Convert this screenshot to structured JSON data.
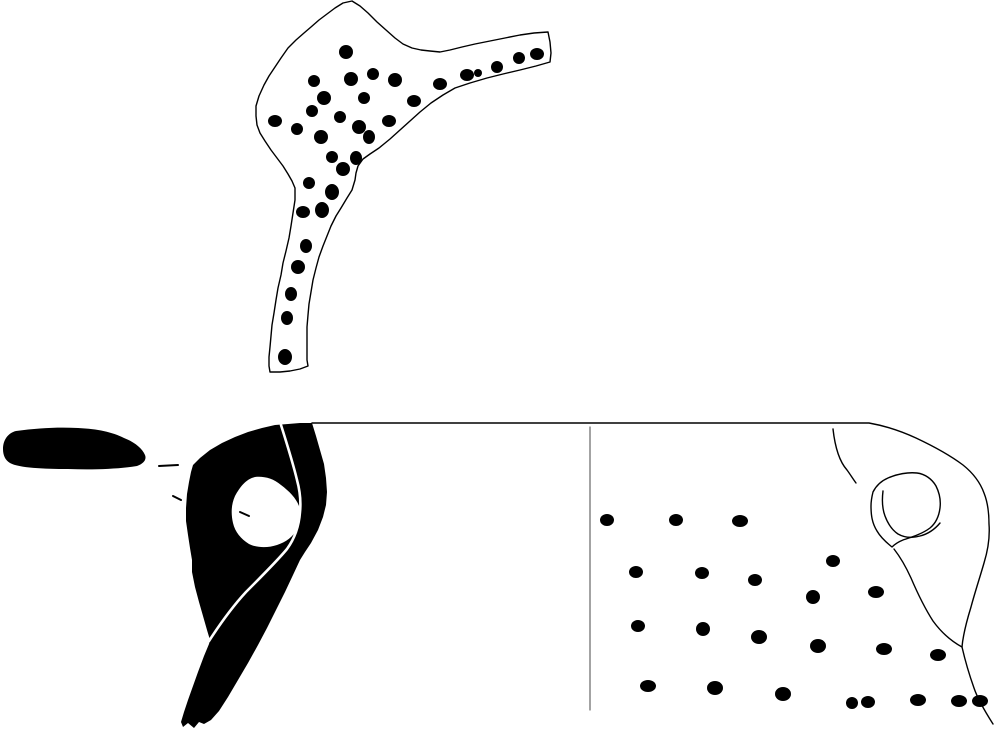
{
  "figure": {
    "canvas": {
      "width": 995,
      "height": 730,
      "background": "#ffffff",
      "ink": "#000000"
    },
    "colors": {
      "ink": "#000000",
      "paper": "#ffffff",
      "divider": "#666666"
    },
    "shapes": [
      {
        "name": "sherd-outline",
        "kind": "path",
        "fill": "none",
        "stroke": "#000000",
        "strokeWidth": 1.4,
        "d": "M 352,1 L 360,6 368,13 377,22 386,30 395,38 403,44 412,48 421,50 430,51 440,52 450,50 462,47 475,44 490,41 505,38 520,35 534,33 548,32 L 550,42 551,53 550,62 L 536,66 520,70 503,74 487,78 470,83 455,88 443,95 431,103 420,112 410,121 400,130 390,139 379,148 370,154 363,159 358,166 356,173 355,180 352,190 347,198 341,208 336,216 331,226 327,236 323,246 319,257 316,268 313,280 311,292 309,304 308,315 307,327 307,339 307,350 307,360 308,366 L 300,369 290,371 280,372 270,372 L 269,366 269,357 270,347 271,336 272,325 274,313 276,300 278,288 281,275 283,263 286,251 289,238 291,226 293,213 295,200 295,188 L 292,181 288,174 283,166 277,158 271,150 265,141 260,133 257,125 256,116 256,106 L 259,96 264,85 269,76 275,67 281,58 288,48 296,40 304,33 311,27 319,20 327,14 335,8 343,3 352,1 Z"
      },
      {
        "name": "sherd-punctate-dots",
        "kind": "dots",
        "fill": "#000000",
        "points": [
          [
            346,
            52,
            7,
            7
          ],
          [
            314,
            81,
            6,
            6
          ],
          [
            351,
            79,
            7,
            7
          ],
          [
            373,
            74,
            6,
            6
          ],
          [
            395,
            80,
            7,
            7
          ],
          [
            440,
            84,
            7,
            6
          ],
          [
            467,
            75,
            7,
            6
          ],
          [
            478,
            73,
            4,
            4
          ],
          [
            497,
            67,
            6,
            6
          ],
          [
            519,
            58,
            6,
            6
          ],
          [
            537,
            54,
            7,
            6
          ],
          [
            324,
            98,
            7,
            7
          ],
          [
            364,
            98,
            6,
            6
          ],
          [
            414,
            101,
            7,
            6
          ],
          [
            312,
            111,
            6,
            6
          ],
          [
            275,
            121,
            7,
            6
          ],
          [
            340,
            117,
            6,
            6
          ],
          [
            359,
            127,
            7,
            7
          ],
          [
            389,
            121,
            7,
            6
          ],
          [
            297,
            129,
            6,
            6
          ],
          [
            321,
            137,
            7,
            7
          ],
          [
            369,
            137,
            6,
            7
          ],
          [
            332,
            157,
            6,
            6
          ],
          [
            356,
            158,
            6,
            7
          ],
          [
            343,
            169,
            7,
            7
          ],
          [
            309,
            183,
            6,
            6
          ],
          [
            332,
            192,
            7,
            8
          ],
          [
            303,
            212,
            7,
            6
          ],
          [
            322,
            210,
            7,
            8
          ],
          [
            306,
            246,
            6,
            7
          ],
          [
            298,
            267,
            7,
            7
          ],
          [
            291,
            294,
            6,
            7
          ],
          [
            287,
            318,
            6,
            7
          ],
          [
            285,
            357,
            7,
            8
          ]
        ]
      },
      {
        "name": "handle-top-profile-solid",
        "kind": "path",
        "fill": "#000000",
        "d": "M 3,449 C 3,440 8,433 16,431 C 38,428 58,427 78,428 C 98,429 112,432 124,438 C 134,442 142,448 145,455 C 147,460 143,464 137,466 C 118,469 93,470 68,469 C 44,469 19,468 10,463 C 5,460 3,455 3,449 Z"
      },
      {
        "name": "leader-dash",
        "kind": "path",
        "fill": "none",
        "stroke": "#000000",
        "strokeWidth": 2,
        "d": "M 159,466 L 178,465"
      },
      {
        "name": "leader-tick",
        "kind": "path",
        "fill": "none",
        "stroke": "#000000",
        "strokeWidth": 2,
        "d": "M 173,496 L 181,500"
      },
      {
        "name": "handle-section-solid",
        "kind": "path",
        "fill": "#000000",
        "d": "M 312,423 L 316,436 320,450 324,464 326,478 327,492 326,505 323,517 318,530 311,543 305,552 300,560 L 293,575 285,592 276,610 267,628 258,645 248,663 238,680 228,697 219,711 211,720 204,724 L 199,722 194,728 188,723 183,727 181,722 L 184,712 188,700 193,686 198,672 204,656 209,644 210,640 L 207,630 203,616 199,602 195,587 192,572 192,560 L 190,548 188,535 186,521 186,508 187,494 189,482 191,472 193,465 L 200,458 210,450 222,443 235,437 248,432 262,428 275,425 288,424 300,423 312,423 Z"
      },
      {
        "name": "handle-section-hole",
        "kind": "path",
        "fill": "#ffffff",
        "d": "M 255,477 C 263,476 273,478 281,485 C 289,491 296,498 299,506 C 301,513 301,521 297,529 C 293,537 286,542 277,545 C 268,548 257,548 249,544 C 241,539 235,532 233,523 C 231,514 231,505 235,496 C 240,487 246,479 255,477 Z"
      },
      {
        "name": "handle-section-highlight-line",
        "kind": "path",
        "fill": "none",
        "stroke": "#ffffff",
        "strokeWidth": 2.6,
        "d": "M 281,425 C 287,444 293,463 297,480 C 300,491 301,502 300,512 C 299,526 295,538 287,549 C 278,560 261,577 246,592 C 233,606 220,624 209,641"
      },
      {
        "name": "hole-tick-mark",
        "kind": "path",
        "fill": "none",
        "stroke": "#000000",
        "strokeWidth": 2,
        "d": "M 240,512 L 249,516"
      },
      {
        "name": "vessel-rim-and-profile",
        "kind": "path",
        "fill": "none",
        "stroke": "#000000",
        "strokeWidth": 1.4,
        "d": "M 312,423 L 590,423 869,423 C 886,426 901,431 916,438 C 933,446 951,456 963,465 C 973,473 980,482 984,493 C 988,503 989,513 989,524 C 990,537 988,550 984,563 C 980,577 975,592 971,607 C 967,620 963,635 962,647 C 965,660 969,674 974,688 C 978,700 986,713 993,724"
      },
      {
        "name": "section-divider-line",
        "kind": "path",
        "fill": "none",
        "stroke": "#666666",
        "strokeWidth": 1.2,
        "d": "M 590,427 L 590,710"
      },
      {
        "name": "vessel-neck-arc",
        "kind": "path",
        "fill": "none",
        "stroke": "#000000",
        "strokeWidth": 1.4,
        "d": "M 833,429 C 835,447 839,461 847,470 C 850,474 853,479 856,483"
      },
      {
        "name": "lug-outer-outline",
        "kind": "path",
        "fill": "none",
        "stroke": "#000000",
        "strokeWidth": 1.4,
        "d": "M 873,492 C 876,486 881,481 888,478 C 897,474 908,472 917,473 C 925,474 932,479 936,486 C 939,492 941,500 940,508 C 939,516 936,523 930,528 C 922,534 912,537 903,540 C 898,542 894,545 892,547 C 887,543 881,538 877,531 C 872,523 871,515 871,506 C 871,501 872,496 873,492 Z"
      },
      {
        "name": "lug-inner-outline",
        "kind": "path",
        "fill": "none",
        "stroke": "#000000",
        "strokeWidth": 1.4,
        "d": "M 883,491 C 882,499 882,508 885,516 C 888,524 892,530 898,534 C 905,538 913,538 920,536 C 928,534 935,529 940,523"
      },
      {
        "name": "vessel-shoulder-curve",
        "kind": "path",
        "fill": "none",
        "stroke": "#000000",
        "strokeWidth": 1.4,
        "d": "M 894,549 C 901,558 906,567 911,578 C 917,592 924,607 933,621 C 941,632 951,641 962,647"
      },
      {
        "name": "vessel-punctate-dots",
        "kind": "dots",
        "fill": "#000000",
        "points": [
          [
            607,
            520,
            7,
            6
          ],
          [
            676,
            520,
            7,
            6
          ],
          [
            740,
            521,
            8,
            6
          ],
          [
            636,
            572,
            7,
            6
          ],
          [
            702,
            573,
            7,
            6
          ],
          [
            755,
            580,
            7,
            6
          ],
          [
            833,
            561,
            7,
            6
          ],
          [
            876,
            592,
            8,
            6
          ],
          [
            813,
            597,
            7,
            7
          ],
          [
            638,
            626,
            7,
            6
          ],
          [
            703,
            629,
            7,
            7
          ],
          [
            759,
            637,
            8,
            7
          ],
          [
            818,
            646,
            8,
            7
          ],
          [
            884,
            649,
            8,
            6
          ],
          [
            938,
            655,
            8,
            6
          ],
          [
            648,
            686,
            8,
            6
          ],
          [
            715,
            688,
            8,
            7
          ],
          [
            783,
            694,
            8,
            7
          ],
          [
            852,
            703,
            6,
            6
          ],
          [
            868,
            702,
            7,
            6
          ],
          [
            918,
            700,
            8,
            6
          ],
          [
            959,
            701,
            8,
            6
          ],
          [
            980,
            701,
            8,
            6
          ]
        ]
      }
    ]
  }
}
